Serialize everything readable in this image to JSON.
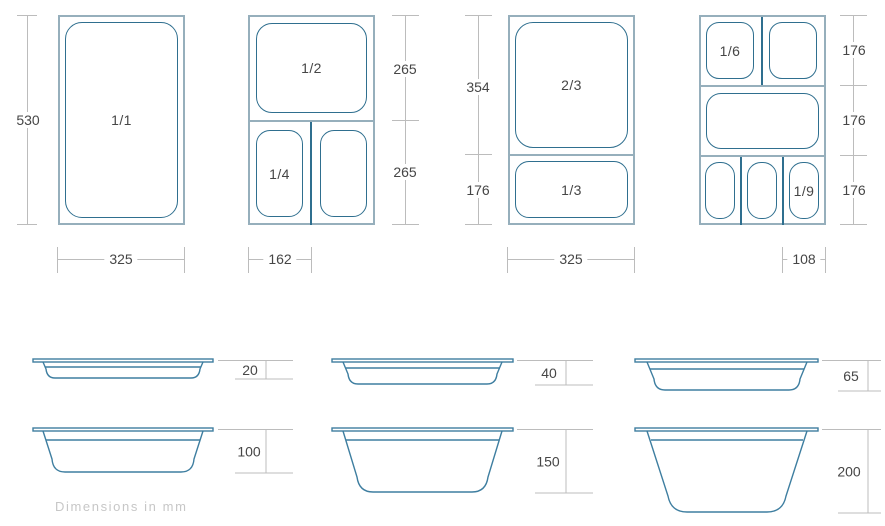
{
  "title": "Gastronorm pan size diagram",
  "footnote": "Dimensions in mm",
  "colors": {
    "container_line": "#96AFBC",
    "pan_line": "#2F6F8F",
    "side_view_line": "#3E7EA0",
    "dimension_line": "#bcbcbc",
    "text": "#464646",
    "footnote_text": "#c7c7c7"
  },
  "top_views": {
    "g1": {
      "pan": "1/1",
      "height": "530",
      "width": "325"
    },
    "g2": {
      "pan_top": "1/2",
      "pan_bottom_left": "1/4",
      "height_top": "265",
      "height_bottom": "265",
      "width": "162"
    },
    "g3": {
      "pan_top": "2/3",
      "pan_bottom": "1/3",
      "height_top": "354",
      "height_bottom": "176",
      "width": "325"
    },
    "g4": {
      "pan_top_left": "1/6",
      "pan_bottom_right": "1/9",
      "height_top": "176",
      "height_middle": "176",
      "height_bottom": "176",
      "width": "108"
    }
  },
  "side_views": [
    {
      "depth": "20"
    },
    {
      "depth": "40"
    },
    {
      "depth": "65"
    },
    {
      "depth": "100"
    },
    {
      "depth": "150"
    },
    {
      "depth": "200"
    }
  ]
}
